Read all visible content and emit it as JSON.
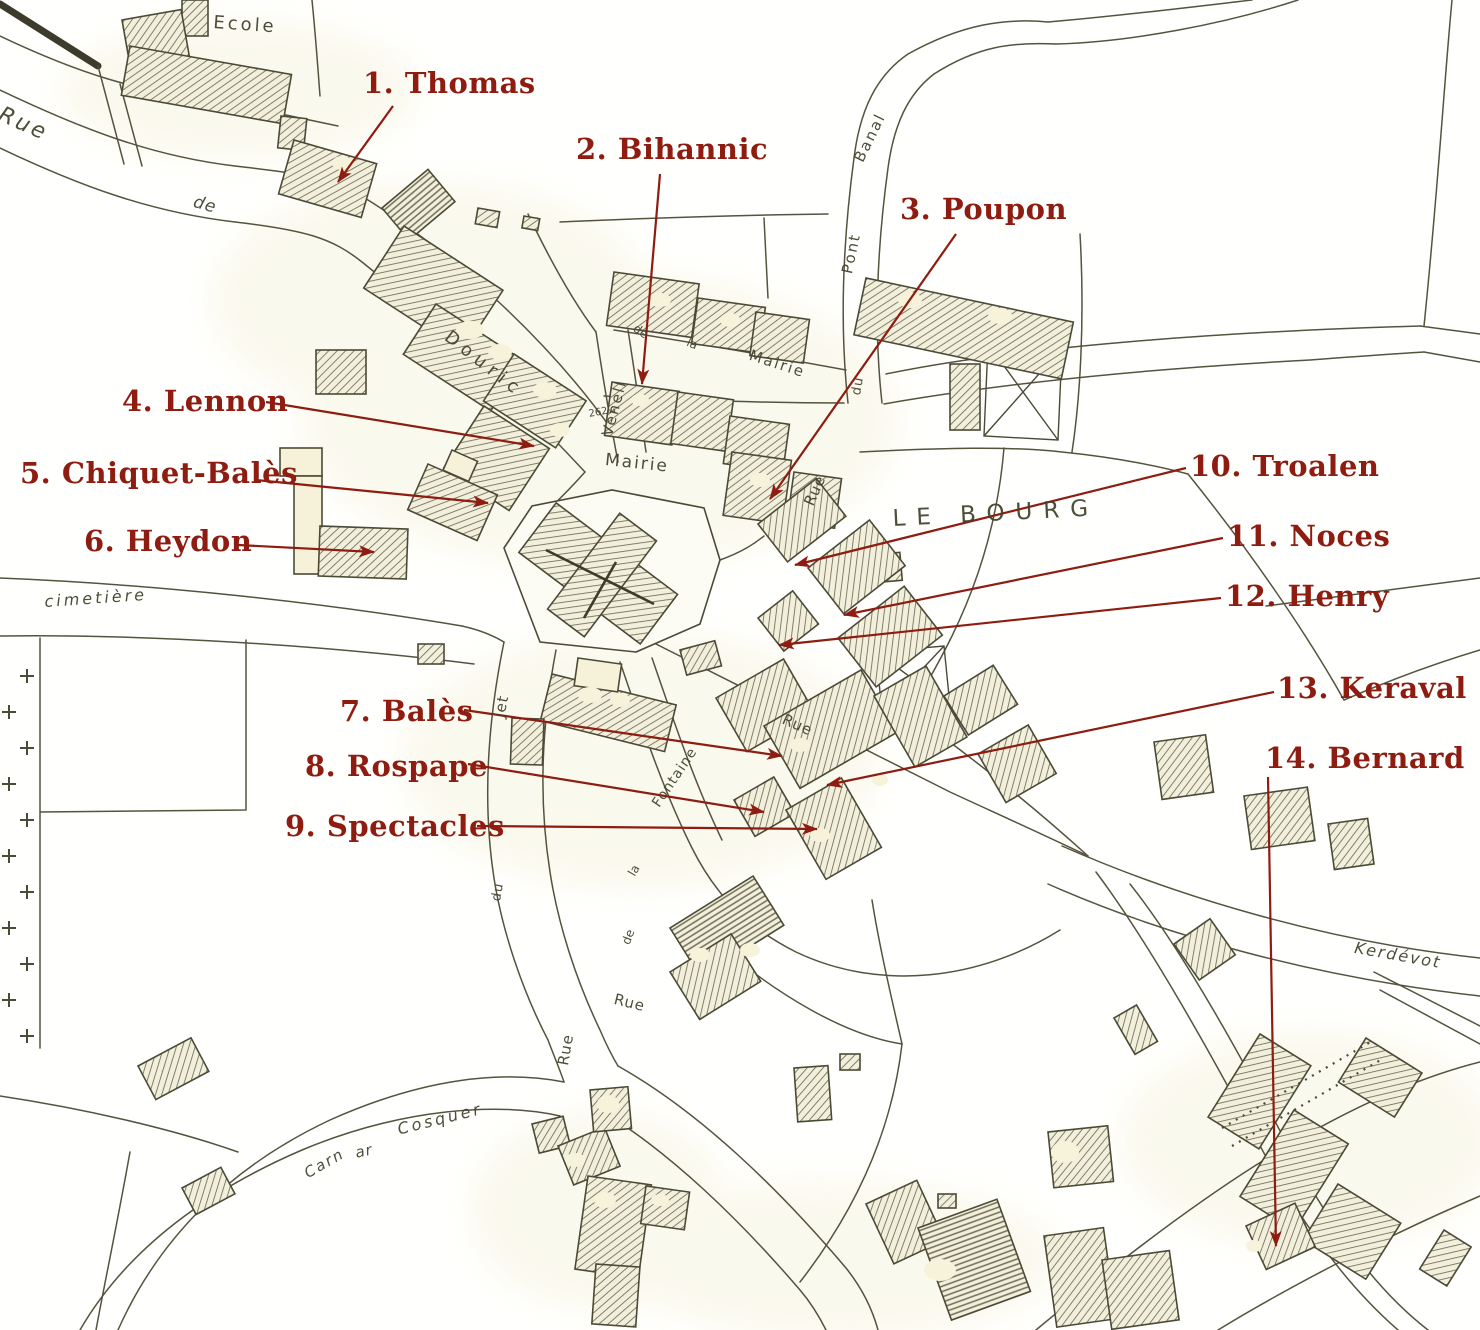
{
  "colors": {
    "annotation_red": "#8E1C10",
    "map_ink": "#4B4A36",
    "road_line": "#55533D",
    "building_fill": "#F2F0DC",
    "cream": "#F6F2D9",
    "paper": "#FFFFFF"
  },
  "annotations": [
    {
      "n": 1,
      "label": "1. Thomas",
      "x": 363,
      "y": 68,
      "arrow": {
        "x1": 393,
        "y1": 106,
        "x2": 338,
        "y2": 182
      }
    },
    {
      "n": 2,
      "label": "2. Bihannic",
      "x": 576,
      "y": 134,
      "arrow": {
        "x1": 660,
        "y1": 174,
        "x2": 642,
        "y2": 384
      }
    },
    {
      "n": 3,
      "label": "3. Poupon",
      "x": 900,
      "y": 194,
      "arrow": {
        "x1": 956,
        "y1": 234,
        "x2": 770,
        "y2": 499
      }
    },
    {
      "n": 4,
      "label": "4. Lennon",
      "x": 122,
      "y": 386,
      "arrow": {
        "x1": 266,
        "y1": 402,
        "x2": 534,
        "y2": 446
      }
    },
    {
      "n": 5,
      "label": "5. Chiquet-Balès",
      "x": 20,
      "y": 458,
      "arrow": {
        "x1": 256,
        "y1": 480,
        "x2": 488,
        "y2": 503
      }
    },
    {
      "n": 6,
      "label": "6. Heydon",
      "x": 84,
      "y": 526,
      "arrow": {
        "x1": 238,
        "y1": 545,
        "x2": 374,
        "y2": 552
      }
    },
    {
      "n": 7,
      "label": "7. Balès",
      "x": 340,
      "y": 696,
      "arrow": {
        "x1": 464,
        "y1": 710,
        "x2": 782,
        "y2": 756
      }
    },
    {
      "n": 8,
      "label": "8. Rospape",
      "x": 305,
      "y": 751,
      "arrow": {
        "x1": 468,
        "y1": 764,
        "x2": 764,
        "y2": 812
      }
    },
    {
      "n": 9,
      "label": "9. Spectacles",
      "x": 285,
      "y": 811,
      "arrow": {
        "x1": 477,
        "y1": 826,
        "x2": 817,
        "y2": 829
      }
    },
    {
      "n": 10,
      "label": "10. Troalen",
      "x": 1190,
      "y": 451,
      "arrow": {
        "x1": 1186,
        "y1": 468,
        "x2": 795,
        "y2": 565
      }
    },
    {
      "n": 11,
      "label": "11. Noces",
      "x": 1227,
      "y": 521,
      "arrow": {
        "x1": 1223,
        "y1": 538,
        "x2": 844,
        "y2": 615
      }
    },
    {
      "n": 12,
      "label": "12. Henry",
      "x": 1225,
      "y": 581,
      "arrow": {
        "x1": 1221,
        "y1": 598,
        "x2": 779,
        "y2": 645
      }
    },
    {
      "n": 13,
      "label": "13. Keraval",
      "x": 1277,
      "y": 673,
      "arrow": {
        "x1": 1274,
        "y1": 692,
        "x2": 827,
        "y2": 785
      }
    },
    {
      "n": 14,
      "label": "14. Bernard",
      "x": 1265,
      "y": 743,
      "arrow": {
        "x1": 1268,
        "y1": 777,
        "x2": 1276,
        "y2": 1246
      }
    }
  ],
  "map_labels": [
    {
      "id": "ecole",
      "text": "Ecole",
      "x": 214,
      "y": 14,
      "size": 18,
      "rot": 4,
      "ls": 3,
      "it": 0
    },
    {
      "id": "rue-nw",
      "text": "Rue",
      "x": 4,
      "y": 104,
      "size": 22,
      "rot": 24,
      "ls": 3,
      "it": 1
    },
    {
      "id": "de-nw",
      "text": "de",
      "x": 196,
      "y": 194,
      "size": 17,
      "rot": 16,
      "ls": 1,
      "it": 1
    },
    {
      "id": "douric",
      "text": "Douric",
      "x": 452,
      "y": 328,
      "size": 18,
      "rot": 38,
      "ls": 6,
      "it": 0
    },
    {
      "id": "venell",
      "text": "Venell",
      "x": 600,
      "y": 434,
      "size": 15,
      "rot": -75,
      "ls": 2,
      "it": 0
    },
    {
      "id": "de-venelle",
      "text": "de",
      "x": 638,
      "y": 322,
      "size": 12,
      "rot": 35,
      "ls": 0,
      "it": 0
    },
    {
      "id": "la-st",
      "text": "la",
      "x": 690,
      "y": 336,
      "size": 12,
      "rot": 25,
      "ls": 0,
      "it": 0
    },
    {
      "id": "mairie-st",
      "text": "Mairie",
      "x": 752,
      "y": 348,
      "size": 15,
      "rot": 18,
      "ls": 2,
      "it": 0
    },
    {
      "id": "mairie-hall",
      "text": "Mairie",
      "x": 606,
      "y": 452,
      "size": 17,
      "rot": 6,
      "ls": 2,
      "it": 0
    },
    {
      "id": "parcel-number",
      "text": "262₄₄",
      "x": 588,
      "y": 410,
      "size": 10,
      "rot": -10,
      "ls": 0,
      "it": 0
    },
    {
      "id": "banal",
      "text": "Banal",
      "x": 852,
      "y": 158,
      "size": 15,
      "rot": -64,
      "ls": 2,
      "it": 0
    },
    {
      "id": "pont",
      "text": "Pont",
      "x": 840,
      "y": 272,
      "size": 15,
      "rot": -78,
      "ls": 2,
      "it": 0
    },
    {
      "id": "du-pont",
      "text": "du",
      "x": 850,
      "y": 394,
      "size": 13,
      "rot": -80,
      "ls": 1,
      "it": 0
    },
    {
      "id": "rue-pont",
      "text": "Rue",
      "x": 802,
      "y": 502,
      "size": 15,
      "rot": -66,
      "ls": 1,
      "it": 0
    },
    {
      "id": "le-bourg",
      "text": "LE BOURG",
      "x": 892,
      "y": 508,
      "size": 23,
      "rot": -3,
      "ls": 11,
      "it": 0
    },
    {
      "id": "cimetiere",
      "text": "cimetière",
      "x": 44,
      "y": 594,
      "size": 16,
      "rot": -4,
      "ls": 3,
      "it": 1
    },
    {
      "id": "rue-mid",
      "text": "Rue",
      "x": 786,
      "y": 712,
      "size": 15,
      "rot": 24,
      "ls": 1,
      "it": 0
    },
    {
      "id": "jet",
      "text": "Jet",
      "x": 492,
      "y": 716,
      "size": 15,
      "rot": -78,
      "ls": 1,
      "it": 0
    },
    {
      "id": "fontaine",
      "text": "Fontaine",
      "x": 650,
      "y": 802,
      "size": 14,
      "rot": -56,
      "ls": 1,
      "it": 0
    },
    {
      "id": "la-fontaine",
      "text": "la",
      "x": 626,
      "y": 872,
      "size": 12,
      "rot": -60,
      "ls": 0,
      "it": 0
    },
    {
      "id": "du-jet",
      "text": "du",
      "x": 490,
      "y": 900,
      "size": 13,
      "rot": -80,
      "ls": 1,
      "it": 0
    },
    {
      "id": "de-fontaine",
      "text": "de",
      "x": 620,
      "y": 942,
      "size": 12,
      "rot": -70,
      "ls": 0,
      "it": 0
    },
    {
      "id": "rue-low",
      "text": "Rue",
      "x": 616,
      "y": 992,
      "size": 15,
      "rot": 14,
      "ls": 1,
      "it": 0
    },
    {
      "id": "rue-jet-low",
      "text": "Rue",
      "x": 556,
      "y": 1064,
      "size": 15,
      "rot": -80,
      "ls": 1,
      "it": 0
    },
    {
      "id": "kerdevot",
      "text": "Kerdévot",
      "x": 1356,
      "y": 940,
      "size": 16,
      "rot": 10,
      "ls": 2,
      "it": 1
    },
    {
      "id": "carn",
      "text": "Carn",
      "x": 302,
      "y": 1168,
      "size": 15,
      "rot": -30,
      "ls": 2,
      "it": 1
    },
    {
      "id": "ar",
      "text": "ar",
      "x": 354,
      "y": 1146,
      "size": 15,
      "rot": -12,
      "ls": 1,
      "it": 1
    },
    {
      "id": "cosquer",
      "text": "Cosquer",
      "x": 396,
      "y": 1122,
      "size": 16,
      "rot": -14,
      "ls": 3,
      "it": 1
    }
  ]
}
